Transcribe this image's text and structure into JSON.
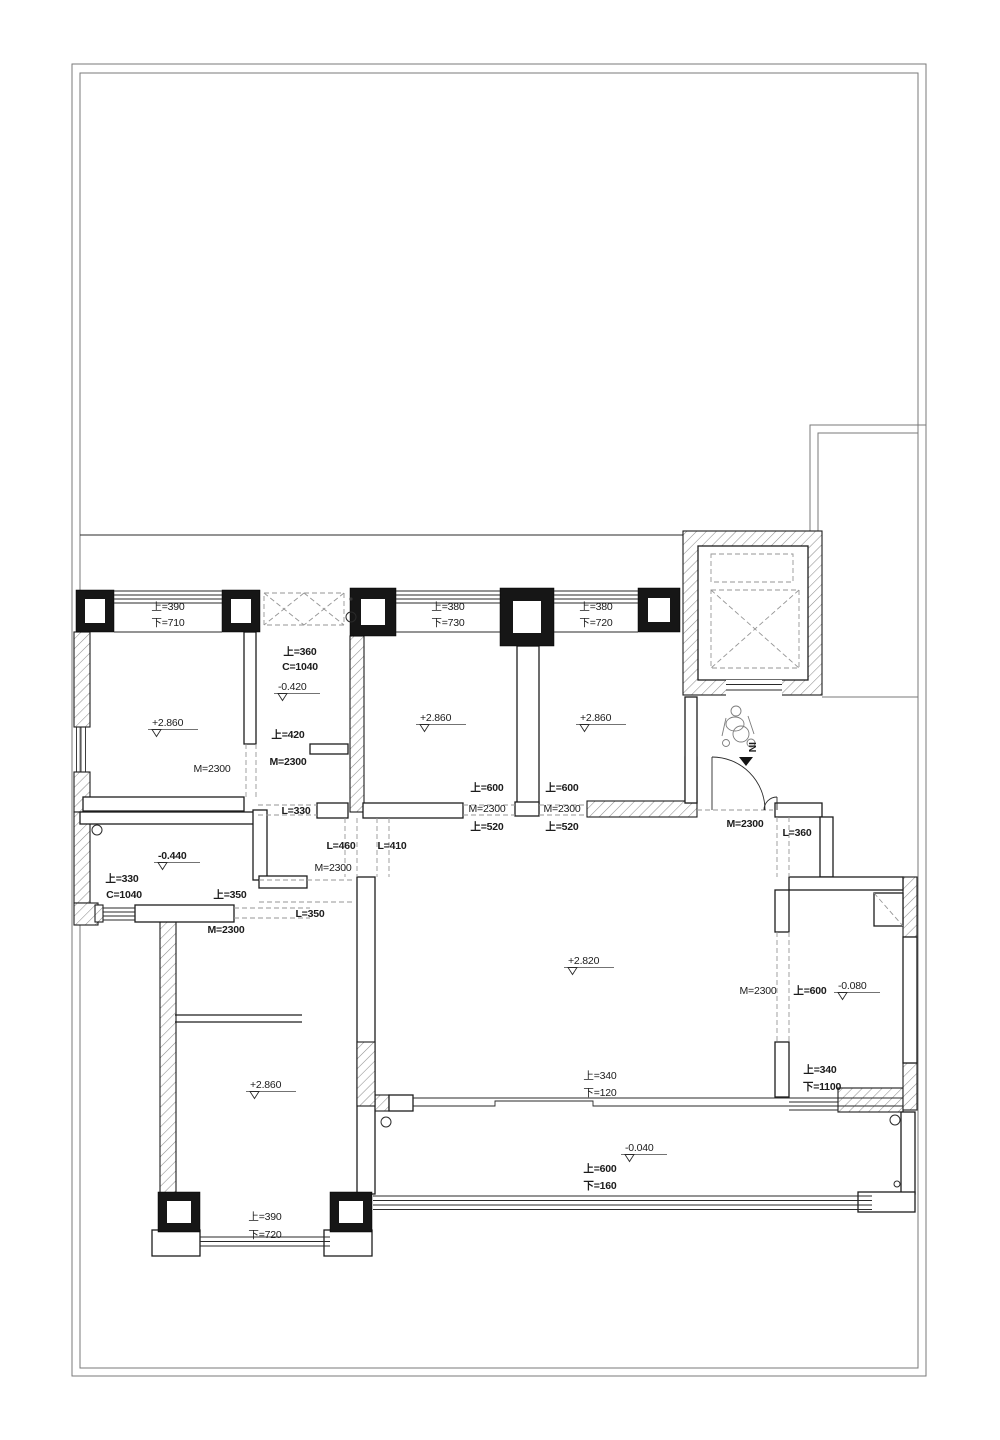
{
  "drawing": {
    "type": "residential-floor-plan",
    "colors": {
      "wall_line": "#1d1d1d",
      "hatch": "#8f8f8f",
      "boundary": "#7a7a7a",
      "dashed": "#969696"
    },
    "annotations": {
      "m2300": "M=2300",
      "up390": "上=390",
      "dn710": "下=710",
      "up380": "上=380",
      "dn730": "下=730",
      "dn720": "下=720",
      "up360": "上=360",
      "c1040": "C=1040",
      "up420": "上=420",
      "up520": "上=520",
      "up600": "上=600",
      "up330": "上=330",
      "up350": "上=350",
      "up340": "上=340",
      "dn1100": "下=1100",
      "dn120": "下=120",
      "dn160": "下=160",
      "l330": "L=330",
      "l350": "L=350",
      "l360": "L=360",
      "l410": "L=410",
      "l460": "L=460",
      "ev286": "+2.860",
      "ev282": "+2.820",
      "evn042": "-0.420",
      "evn044": "-0.440",
      "evn008": "-0.080",
      "evn004": "-0.040",
      "in_label": "IN"
    }
  }
}
